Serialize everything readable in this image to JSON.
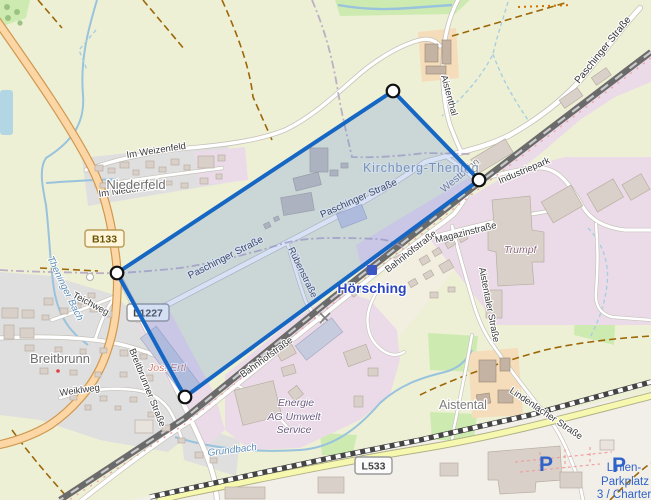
{
  "shields": {
    "b133": "B133",
    "l1227": "L1227",
    "l533": "L533"
  },
  "places": {
    "niederfeld": "Niederfeld",
    "breitbrunn": "Breitbrunn",
    "kirchberg_thening": "Kirchberg-Thening",
    "hoersching": "Hörsching",
    "aistental": "Aistental"
  },
  "streets": {
    "im_weizenfeld": "Im Weizenfeld",
    "im_niederfeld": "Im Niederfeld",
    "teichweg": "Teichweg",
    "weiklweg": "Weiklweg",
    "breitbrunner": "Breitbrunner Straße",
    "paschinger": "Paschinger Straße",
    "ruebenstrasse": "Rübenstraße",
    "bahnhofstrasse": "Bahnhofstraße",
    "magazinstrasse": "Magazinstraße",
    "aistentaler": "Aistentaler Straße",
    "aistenthal": "Aistenthal",
    "industriepark": "Industriepark",
    "lindenlacher": "Lindenlacher Straße"
  },
  "railway": {
    "name": "Westbahn"
  },
  "waters": {
    "theninger_bach": "Theninger Bach",
    "grundbach": "Grundbach"
  },
  "pois": {
    "trumpf": "Trumpf",
    "jos_ertl": "Jos. Ertl",
    "energie": [
      "Energie",
      "AG Umwelt",
      "Service"
    ],
    "parking_symbol": "P",
    "parking_label": [
      "Linien-",
      "Parkplatz",
      "3 / Charter-"
    ]
  },
  "palette": {
    "selection_stroke": "#1666c4",
    "selection_fill": "rgba(100,140,220,0.25)",
    "station_blue": "#2b45c0",
    "parking_blue": "#2f63c9",
    "primary_road": "#fcd6a4",
    "tertiary_road": "#f6f8af",
    "farmland": "#eef0d5",
    "residential": "#e0dfdf",
    "industrial": "#ebdbe8",
    "farmyard": "#f5dcba",
    "grass": "#cdebb0",
    "water": "#99c3dd"
  }
}
